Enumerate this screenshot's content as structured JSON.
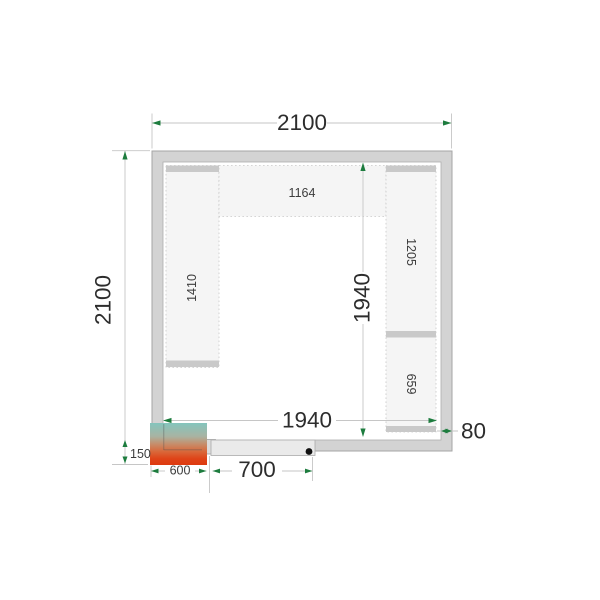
{
  "dimensions": {
    "overall_width": "2100",
    "overall_height": "2100",
    "interior_width": "1940",
    "interior_height": "1940",
    "wall_thickness": "80",
    "door_opening": "700",
    "cooling_unit_width": "600",
    "cooling_unit_depth": "150"
  },
  "shelves": {
    "top": "1164",
    "left": "1410",
    "right_upper": "1205",
    "right_lower": "659"
  },
  "colors": {
    "wall_fill": "#d3d3d3",
    "interior_fill": "#ffffff",
    "shelf_fill": "#f5f5f5",
    "shelf_cap_fill": "#c9c9c9",
    "door_panel_fill": "#eaeaea",
    "door_jamb_fill": "#dcdcdc",
    "hinge_dot_fill": "#111111",
    "dimension_line": "#c6c6c6",
    "arrow_green": "#1d7c3e",
    "unit_gradient_top": "#84c5bd",
    "unit_gradient_bottom": "#dd3a10"
  }
}
